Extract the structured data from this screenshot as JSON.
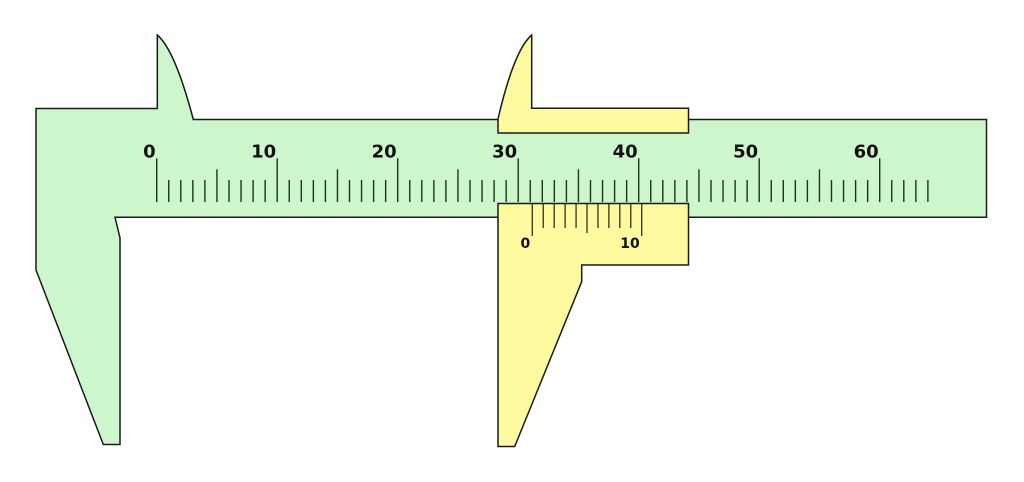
{
  "figure": {
    "name": "vernier-caliper-diagram",
    "background": "#ffffff",
    "colors": {
      "body_fill": "#cdf6cd",
      "slider_fill": "#fdfaa0",
      "outline": "#1a1a1a",
      "main_tick": "#1d331d",
      "vernier_tick": "#33331a",
      "label": "#111111"
    },
    "main_scale": {
      "tick_count": 65,
      "start_x": 156.7,
      "spacing": 12.05,
      "tick_bottom_y": 202,
      "major_top_y": 158.3,
      "medium_top_y": 169.3,
      "minor_top_y": 180,
      "major_every": 10,
      "medium_every": 5,
      "tick_width": 1.4,
      "label_baseline_y": 157.5,
      "label_font_size": 18,
      "label_offset_x": -1,
      "labels": [
        {
          "value": "0",
          "index": 0
        },
        {
          "value": "10",
          "index": 10
        },
        {
          "value": "20",
          "index": 20
        },
        {
          "value": "30",
          "index": 30
        },
        {
          "value": "40",
          "index": 40
        },
        {
          "value": "50",
          "index": 50
        },
        {
          "value": "60",
          "index": 60
        }
      ]
    },
    "vernier_scale": {
      "tick_count": 11,
      "start_x": 532.3,
      "spacing": 10.94,
      "tick_top_y": 204,
      "major_bottom_y": 236,
      "medium_bottom_y": 233,
      "minor_bottom_y": 228,
      "major_every": 10,
      "medium_every": 5,
      "tick_width": 1.3,
      "label_baseline_y": 248,
      "label_font_size": 14,
      "label_offset_x": -2,
      "labels": [
        {
          "value": "0",
          "index": 0
        },
        {
          "value": "10",
          "index": 10
        }
      ]
    }
  }
}
